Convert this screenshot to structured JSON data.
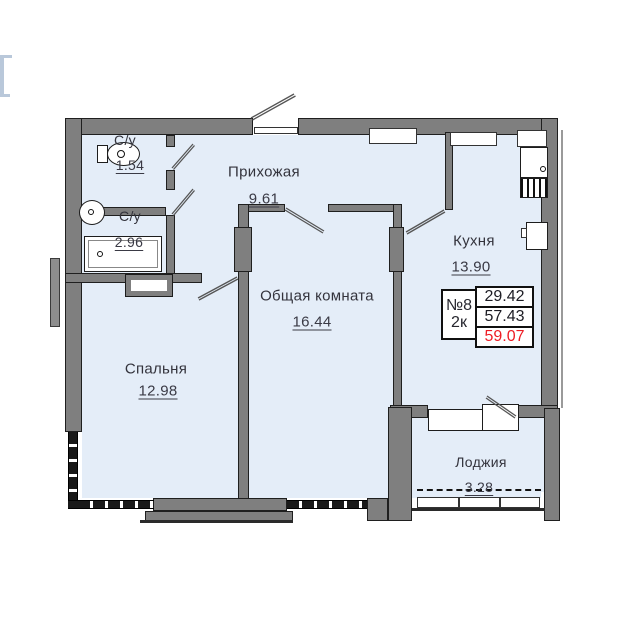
{
  "plan_title": "План квартиры №8",
  "info_box": {
    "unit": "№8",
    "type": "2к",
    "values": [
      "29.42",
      "57.43",
      "59.07"
    ]
  },
  "rooms": {
    "bath1": {
      "label": "С/у",
      "area": "1.54"
    },
    "bath2": {
      "label": "С/у",
      "area": "2.96"
    },
    "hall": {
      "label": "Прихожая",
      "area": "9.61"
    },
    "kitchen": {
      "label": "Кухня",
      "area": "13.90"
    },
    "living": {
      "label": "Общая комната",
      "area": "16.44"
    },
    "bedroom": {
      "label": "Спальня",
      "area": "12.98"
    },
    "loggia": {
      "label": "Лоджия",
      "area": "3.28"
    }
  },
  "icons": [
    "toilet-icon",
    "washbasin-icon",
    "bathtub-icon",
    "kitchen-sink-icon",
    "stove-icon",
    "fridge-icon"
  ],
  "colors": {
    "room_fill": "#e4edf8",
    "wall_gray": "#7f7f7f",
    "outline": "#1f1f1f",
    "accent_red": "#ee1c24",
    "text": "#33333c"
  }
}
